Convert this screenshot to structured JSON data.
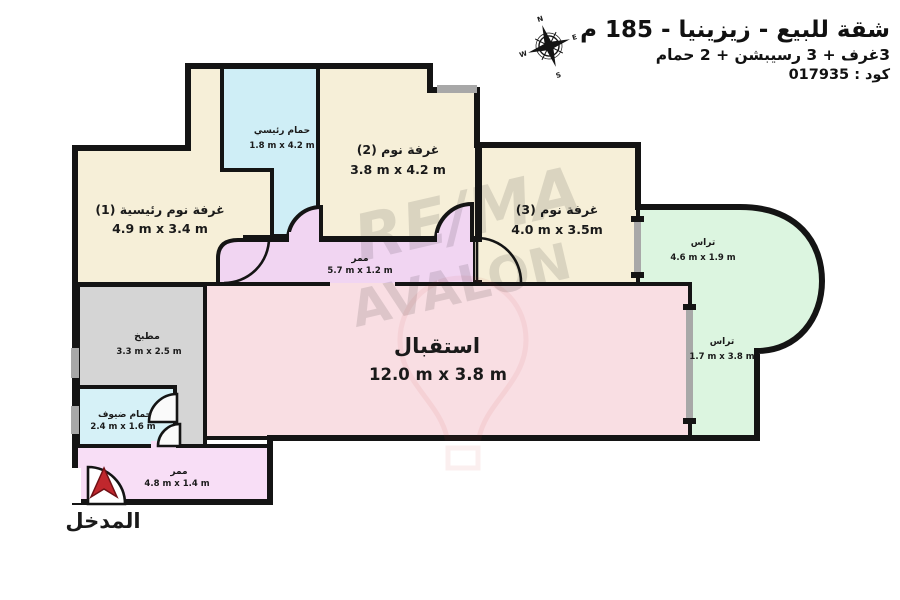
{
  "header": {
    "title": "شقة للبيع - زيزينيا - 185 م",
    "subtitle": "3غرف + 3 رسيبشن + 2 حمام",
    "code_line": "كود : 017935"
  },
  "compass": {
    "north": "N",
    "east": "E",
    "south": "S",
    "west": "W"
  },
  "watermark": {
    "line1": "RE/MA",
    "line2": "AVALON"
  },
  "entrance": {
    "label": "المدخل"
  },
  "rooms": {
    "master_bedroom": {
      "name": "غرفة نوم رئيسية (1)",
      "dims": "4.9 m x 3.4 m"
    },
    "main_bathroom": {
      "name": "حمام رئيسي",
      "dims": "1.8 m x 4.2 m"
    },
    "bedroom_2": {
      "name": "غرفة نوم (2)",
      "dims": "3.8 m x 4.2 m"
    },
    "bedroom_3": {
      "name": "غرفة نوم (3)",
      "dims": "4.0 m x 3.5m"
    },
    "terrace_1": {
      "name": "تراس",
      "dims": "4.6 m x 1.9 m"
    },
    "terrace_2": {
      "name": "تراس",
      "dims": "1.7 m x 3.8 m"
    },
    "hallway": {
      "name": "ممر",
      "dims": "5.7 m x 1.2 m"
    },
    "reception": {
      "name": "استقبال",
      "dims": "12.0 m x 3.8 m"
    },
    "kitchen": {
      "name": "مطبخ",
      "dims": "3.3 m x 2.5 m"
    },
    "guest_bathroom": {
      "name": "حمام ضيوف",
      "dims": "2.4 m x 1.6 m"
    },
    "entry_hall": {
      "name": "ممر",
      "dims": "4.8 m x 1.4 m"
    }
  },
  "colors": {
    "wall": "#141414",
    "cream_room": "#f6efd8",
    "bathroom": "#cfeef6",
    "terrace": "#dcf5e0",
    "hallway": "#f1d5f2",
    "reception": "#f9dee3",
    "kitchen": "#d5d5d5",
    "entry_hall": "#f8def6",
    "window": "#a8a8a8",
    "entrance_arrow": "#c0272d",
    "watermark_red": "#cc3333",
    "watermark_blue": "#3a5fa8"
  }
}
